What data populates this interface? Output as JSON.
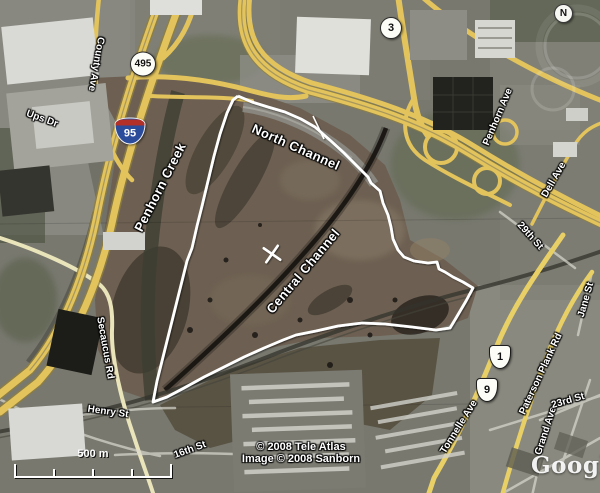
{
  "map": {
    "water_labels": [
      {
        "text": "Penhorn Creek",
        "x": 160,
        "y": 187,
        "rot": -63
      },
      {
        "text": "North Channel",
        "x": 296,
        "y": 147,
        "rot": 24
      },
      {
        "text": "Central Channel",
        "x": 303,
        "y": 271,
        "rot": -50
      }
    ],
    "street_labels": [
      {
        "text": "County Ave",
        "x": 96,
        "y": 64,
        "rot": 100
      },
      {
        "text": "Ups Dr",
        "x": 42,
        "y": 119,
        "rot": 20
      },
      {
        "text": "Penhorn Ave",
        "x": 498,
        "y": 117,
        "rot": -67
      },
      {
        "text": "Dell Ave",
        "x": 554,
        "y": 180,
        "rot": -60
      },
      {
        "text": "29th St",
        "x": 530,
        "y": 236,
        "rot": 48
      },
      {
        "text": "Jane St",
        "x": 586,
        "y": 300,
        "rot": -74
      },
      {
        "text": "Secaucus Rd",
        "x": 105,
        "y": 348,
        "rot": 80
      },
      {
        "text": "Henry St",
        "x": 108,
        "y": 412,
        "rot": 8
      },
      {
        "text": "16th St",
        "x": 190,
        "y": 450,
        "rot": -20
      },
      {
        "text": "Tonnelle Ave",
        "x": 459,
        "y": 427,
        "rot": -58
      },
      {
        "text": "Paterson Plank Rd",
        "x": 541,
        "y": 374,
        "rot": -65
      },
      {
        "text": "Grand Ave",
        "x": 546,
        "y": 431,
        "rot": -72
      },
      {
        "text": "23rd St",
        "x": 568,
        "y": 401,
        "rot": -16
      }
    ],
    "shields": [
      {
        "type": "circle",
        "label": "495",
        "x": 143,
        "y": 64
      },
      {
        "type": "circle",
        "label": "3",
        "x": 391,
        "y": 28,
        "small": true
      },
      {
        "type": "interstate",
        "label": "95",
        "x": 130,
        "y": 131
      },
      {
        "type": "us",
        "label": "1",
        "x": 500,
        "y": 357
      },
      {
        "type": "us",
        "label": "9",
        "x": 487,
        "y": 390
      }
    ],
    "compass": {
      "label": "N"
    },
    "scale_bar": {
      "label": "500 m"
    },
    "attribution": {
      "line1": "© 2008 Tele Atlas",
      "line2": "Image © 2008 Sanborn"
    },
    "watermark": {
      "label": "Google"
    },
    "colors": {
      "site_boundary": "#ffffff",
      "highway_yellow": "#e2c35c",
      "minor_road": "#eae4bb",
      "marsh_brown": "#6d6052",
      "urban_gray": "#8c8c83",
      "label_text": "#ffffff",
      "label_outline": "#000000"
    }
  }
}
